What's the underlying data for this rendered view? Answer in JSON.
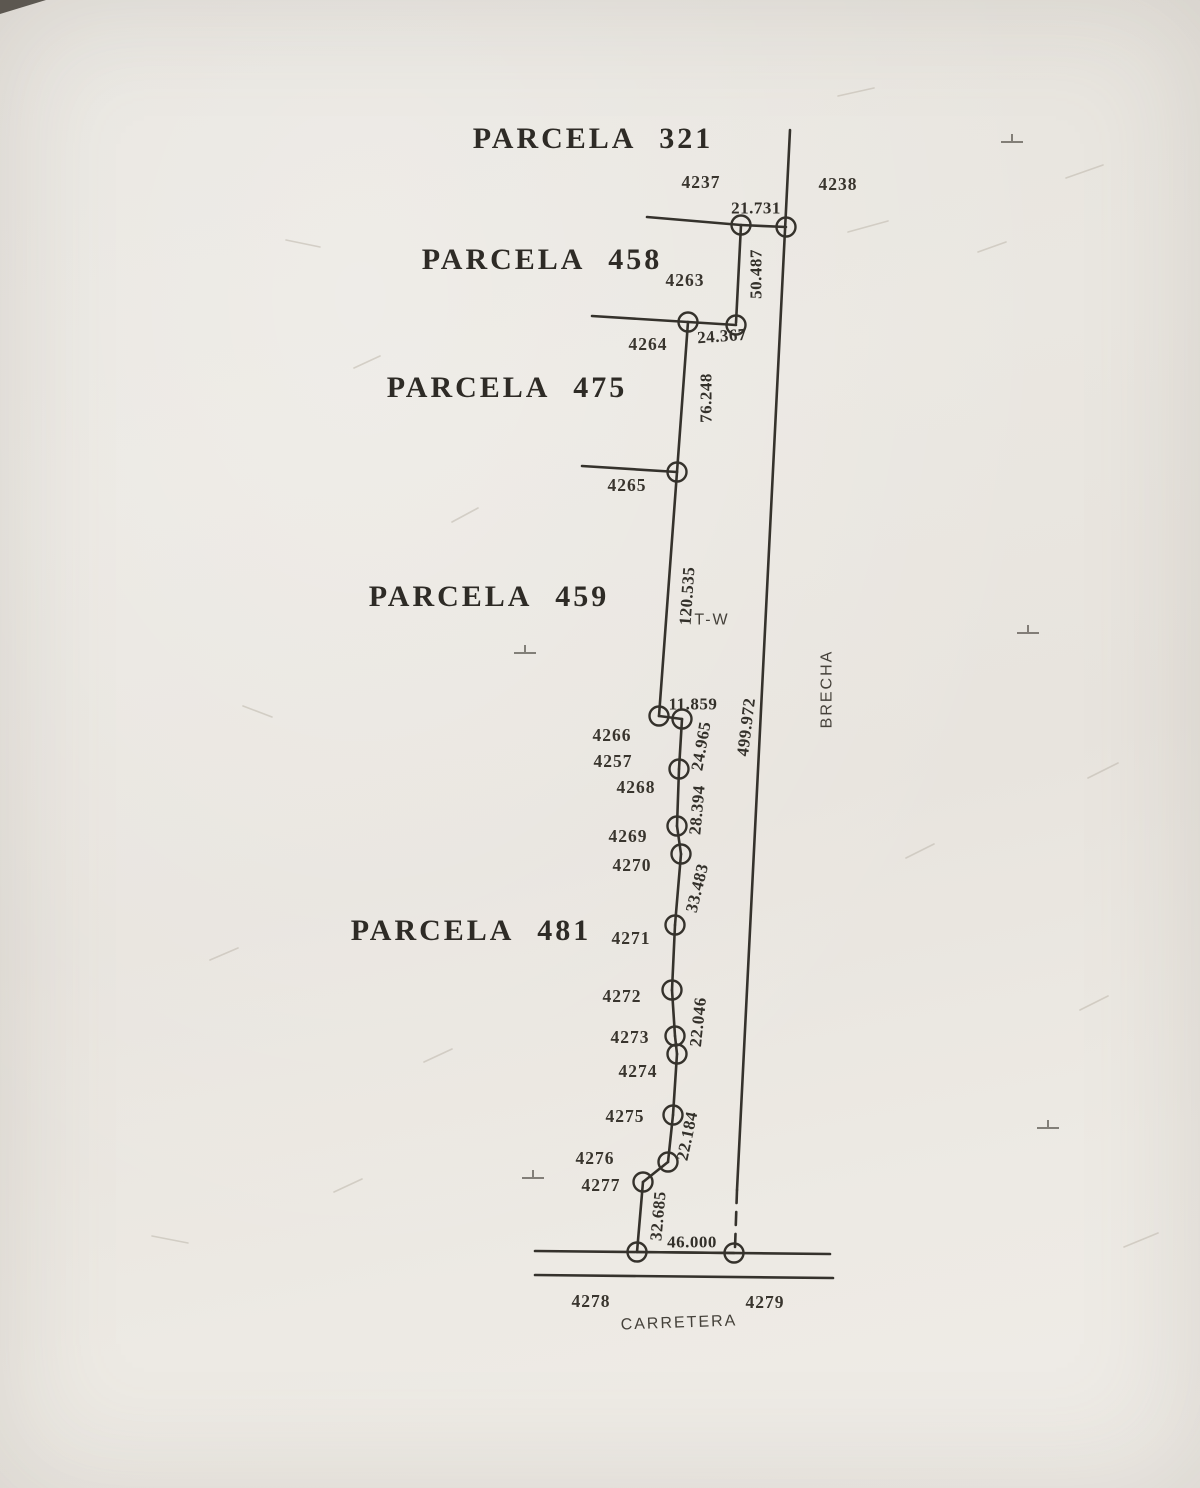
{
  "colors": {
    "paper": "#eae7e1",
    "ink": "#35322c",
    "faint_ink": "#55514a",
    "scratch": "#bdb7ab"
  },
  "parcels": [
    {
      "label": "PARCELA 321",
      "x": 593,
      "y": 148
    },
    {
      "label": "PARCELA 458",
      "x": 542,
      "y": 269
    },
    {
      "label": "PARCELA 475",
      "x": 507,
      "y": 397
    },
    {
      "label": "PARCELA 459",
      "x": 489,
      "y": 606
    },
    {
      "label": "PARCELA 481",
      "x": 471,
      "y": 940
    }
  ],
  "points": [
    {
      "id": "4237",
      "x": 701,
      "y": 188
    },
    {
      "id": "4238",
      "x": 838,
      "y": 190
    },
    {
      "id": "4263",
      "x": 685,
      "y": 286
    },
    {
      "id": "4264",
      "x": 648,
      "y": 350
    },
    {
      "id": "4265",
      "x": 627,
      "y": 491
    },
    {
      "id": "4266",
      "x": 612,
      "y": 741
    },
    {
      "id": "4257",
      "x": 613,
      "y": 767
    },
    {
      "id": "4268",
      "x": 636,
      "y": 793
    },
    {
      "id": "4269",
      "x": 628,
      "y": 842
    },
    {
      "id": "4270",
      "x": 632,
      "y": 871
    },
    {
      "id": "4271",
      "x": 631,
      "y": 944
    },
    {
      "id": "4272",
      "x": 622,
      "y": 1002
    },
    {
      "id": "4273",
      "x": 630,
      "y": 1043
    },
    {
      "id": "4274",
      "x": 638,
      "y": 1077
    },
    {
      "id": "4275",
      "x": 625,
      "y": 1122
    },
    {
      "id": "4276",
      "x": 595,
      "y": 1164
    },
    {
      "id": "4277",
      "x": 601,
      "y": 1191
    },
    {
      "id": "4278",
      "x": 591,
      "y": 1307
    },
    {
      "id": "4279",
      "x": 765,
      "y": 1308
    }
  ],
  "distances": [
    {
      "value": "21.731",
      "x": 756,
      "y": 208,
      "rot": 0
    },
    {
      "value": "50.487",
      "x": 756,
      "y": 274,
      "rot": -90
    },
    {
      "value": "24.367",
      "x": 722,
      "y": 336,
      "rot": -4
    },
    {
      "value": "76.248",
      "x": 706,
      "y": 398,
      "rot": -90
    },
    {
      "value": "120.535",
      "x": 687,
      "y": 596,
      "rot": -86
    },
    {
      "value": "11.859",
      "x": 693,
      "y": 704,
      "rot": 0
    },
    {
      "value": "24.965",
      "x": 701,
      "y": 746,
      "rot": -80
    },
    {
      "value": "28.394",
      "x": 697,
      "y": 810,
      "rot": -85
    },
    {
      "value": "33.483",
      "x": 697,
      "y": 888,
      "rot": -76
    },
    {
      "value": "22.046",
      "x": 698,
      "y": 1022,
      "rot": -84
    },
    {
      "value": "22.184",
      "x": 687,
      "y": 1136,
      "rot": -78
    },
    {
      "value": "32.685",
      "x": 658,
      "y": 1216,
      "rot": -85
    },
    {
      "value": "46.000",
      "x": 692,
      "y": 1242,
      "rot": 0
    },
    {
      "value": "499.972",
      "x": 746,
      "y": 727,
      "rot": -83
    }
  ],
  "annotations": [
    {
      "text": "T-W",
      "x": 712,
      "y": 620,
      "size": 16,
      "rot": 0,
      "spacing": 2
    },
    {
      "text": "BRECHA",
      "x": 827,
      "y": 689,
      "size": 15.5,
      "rot": -90,
      "spacing": 2.5
    },
    {
      "text": "CARRETERA",
      "x": 679,
      "y": 1323,
      "size": 17.5,
      "rot": -2,
      "spacing": 2.5
    }
  ],
  "geometry": {
    "segments": [
      [
        647,
        217,
        741,
        225
      ],
      [
        741,
        225,
        786,
        227
      ],
      [
        790,
        130,
        737,
        1190
      ],
      [
        741,
        225,
        736,
        323
      ],
      [
        688,
        322,
        736,
        325
      ],
      [
        592,
        316,
        688,
        322
      ],
      [
        688,
        322,
        677,
        472
      ],
      [
        582,
        466,
        677,
        472
      ],
      [
        677,
        472,
        659,
        716
      ],
      [
        659,
        716,
        682,
        719
      ],
      [
        682,
        719,
        679,
        769
      ],
      [
        679,
        769,
        677,
        826
      ],
      [
        677,
        826,
        681,
        854
      ],
      [
        681,
        854,
        675,
        925
      ],
      [
        675,
        925,
        672,
        990
      ],
      [
        672,
        990,
        675,
        1036
      ],
      [
        675,
        1036,
        677,
        1054
      ],
      [
        677,
        1054,
        673,
        1115
      ],
      [
        673,
        1115,
        668,
        1162
      ],
      [
        668,
        1162,
        643,
        1182
      ],
      [
        643,
        1182,
        637,
        1252
      ],
      [
        535,
        1251,
        830,
        1254
      ],
      [
        535,
        1275,
        833,
        1278
      ],
      [
        637,
        1252,
        734,
        1253
      ]
    ],
    "dashed_segments": [
      [
        737,
        1190,
        735,
        1248
      ]
    ],
    "stations": [
      [
        741,
        225
      ],
      [
        786,
        227
      ],
      [
        688,
        322
      ],
      [
        736,
        325
      ],
      [
        677,
        472
      ],
      [
        659,
        716
      ],
      [
        682,
        719
      ],
      [
        679,
        769
      ],
      [
        677,
        826
      ],
      [
        681,
        854
      ],
      [
        675,
        925
      ],
      [
        672,
        990
      ],
      [
        675,
        1036
      ],
      [
        677,
        1054
      ],
      [
        673,
        1115
      ],
      [
        668,
        1162
      ],
      [
        643,
        1182
      ],
      [
        637,
        1252
      ],
      [
        734,
        1253
      ]
    ],
    "reg_marks": [
      [
        1012,
        142
      ],
      [
        525,
        653
      ],
      [
        1028,
        633
      ],
      [
        1048,
        1128
      ],
      [
        533,
        1178
      ]
    ],
    "scratches": [
      [
        848,
        232,
        888,
        221
      ],
      [
        1066,
        178,
        1103,
        165
      ],
      [
        838,
        96,
        874,
        88
      ],
      [
        286,
        240,
        320,
        247
      ],
      [
        452,
        522,
        478,
        508
      ],
      [
        243,
        706,
        272,
        717
      ],
      [
        1088,
        778,
        1118,
        763
      ],
      [
        906,
        858,
        934,
        844
      ],
      [
        334,
        1192,
        362,
        1179
      ],
      [
        152,
        1236,
        188,
        1243
      ],
      [
        1124,
        1247,
        1158,
        1233
      ],
      [
        424,
        1062,
        452,
        1049
      ],
      [
        978,
        252,
        1006,
        242
      ],
      [
        354,
        368,
        380,
        356
      ],
      [
        210,
        960,
        238,
        948
      ],
      [
        1080,
        1010,
        1108,
        996
      ]
    ],
    "corner_wedge": "0,0 46,0 0,14"
  }
}
